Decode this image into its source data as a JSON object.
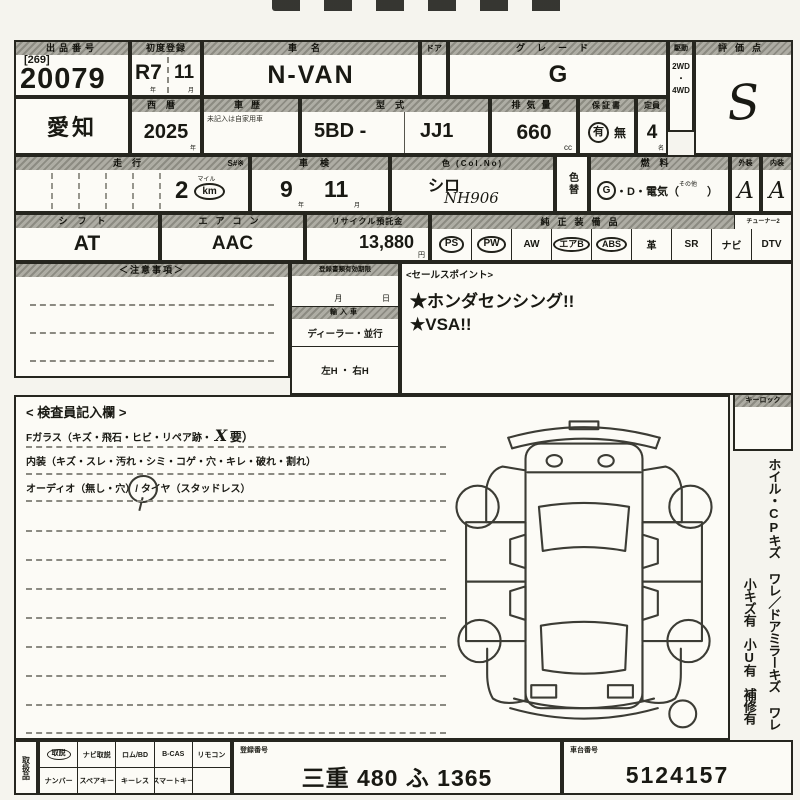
{
  "row1": {
    "auction_label": "出品番号",
    "auction_bracket": "[269]",
    "auction_no": "20079",
    "firstreg_label": "初度登録",
    "firstreg_era": "R7",
    "firstreg_month": "11",
    "year_char": "年",
    "month_char": "月",
    "carname_label": "車名",
    "carname": "N-VAN",
    "door_label": "ドア",
    "grade_label": "グレード",
    "grade": "G",
    "drive_label": "駆動",
    "drive_2wd": "2WD",
    "drive_dot": "・",
    "drive_4wd": "4WD",
    "score_label": "評価点",
    "score": "S"
  },
  "row2": {
    "region": "愛知",
    "year_label": "西暦",
    "year": "2025",
    "year_char": "年",
    "history_label": "車歴",
    "history_note": "未記入は自家用車",
    "model_label": "型式",
    "model_prefix": "5BD -",
    "model_code": "JJ1",
    "disp_label": "排気量",
    "disp": "660",
    "disp_unit": "cc",
    "warranty_label": "保証書",
    "warranty_yes": "有",
    "warranty_no": "無",
    "capacity_label": "定員",
    "capacity": "4",
    "capacity_unit": "名"
  },
  "row3": {
    "mileage_label": "走行",
    "mileage_s": "S#※",
    "mileage": "2",
    "mile_char": "マイル",
    "km_char": "km",
    "shaken_label": "車検",
    "shaken_year": "9",
    "year_char": "年",
    "shaken_month": "11",
    "month_char": "月",
    "color_label": "色 (Col.No)",
    "color": "シロ",
    "color_no": "NH906",
    "colorchange_label": "色替",
    "fuel_label": "燃料",
    "fuel_g": "G",
    "fuel_rest": "・D・電気（",
    "fuel_other": "その他",
    "fuel_close": "）",
    "ext_label": "外装",
    "ext": "A",
    "int_label": "内装",
    "int": "A"
  },
  "row4": {
    "shift_label": "シフト",
    "shift": "AT",
    "ac_label": "エアコン",
    "ac": "AAC",
    "recycle_label": "リサイクル預託金",
    "recycle": "13,880",
    "yen_char": "円",
    "equip_label": "純正装備品",
    "tuner_label": "チューナー2",
    "equipment": [
      {
        "label": "PS",
        "circled": true
      },
      {
        "label": "PW",
        "circled": true
      },
      {
        "label": "AW",
        "circled": false
      },
      {
        "label": "エアB",
        "circled": true
      },
      {
        "label": "ABS",
        "circled": true
      },
      {
        "label": "革",
        "circled": false
      },
      {
        "label": "SR",
        "circled": false
      },
      {
        "label": "ナビ",
        "circled": false
      },
      {
        "label": "DTV",
        "circled": false
      }
    ]
  },
  "notes": {
    "label": "＜注意事項＞"
  },
  "docs": {
    "expiry_label": "登録書類有効期限",
    "month_char": "月",
    "day_char": "日",
    "import_label": "輸入車",
    "import_options": "ディーラー・並行",
    "handle_options": "左H ・ 右H"
  },
  "sales": {
    "label": "<セールスポイント>",
    "point1": "★ホンダセンシング!!",
    "point2": "★VSA!!"
  },
  "inspector": {
    "title": "< 検査員記入欄 >",
    "line1_pre": "Fガラス（キズ・飛石・ヒビ・リペア跡・",
    "line1_mark": "X",
    "line1_post": "要）",
    "line2": "内装（キズ・スレ・汚れ・シミ・コゲ・穴・キレ・破れ・割れ）",
    "line3": "オーディオ（無し・穴）/ タイヤ（スタッドレス）"
  },
  "keylock": {
    "label": "キーロック"
  },
  "margin": {
    "line1": "ホイル・CPキズ ワレ／ドアミラーキズ ワレ",
    "line2": "小キズ有　小U有　補修有"
  },
  "bottom": {
    "items_label": "取扱品",
    "row1": [
      {
        "label": "取説",
        "circled": true
      },
      {
        "label": "ナビ取説",
        "circled": false
      },
      {
        "label": "ロム/BD",
        "circled": false
      },
      {
        "label": "B-CAS",
        "circled": false
      },
      {
        "label": "リモコン",
        "circled": false
      }
    ],
    "row2": [
      {
        "label": "ナンバー"
      },
      {
        "label": "スペアキー"
      },
      {
        "label": "キーレス"
      },
      {
        "label": "スマートキー"
      },
      {
        "label": ""
      }
    ],
    "reg_label": "登録番号",
    "reg_no": "三重 480 ふ 1365",
    "chassis_label": "車台番号",
    "chassis_no": "5124157"
  }
}
